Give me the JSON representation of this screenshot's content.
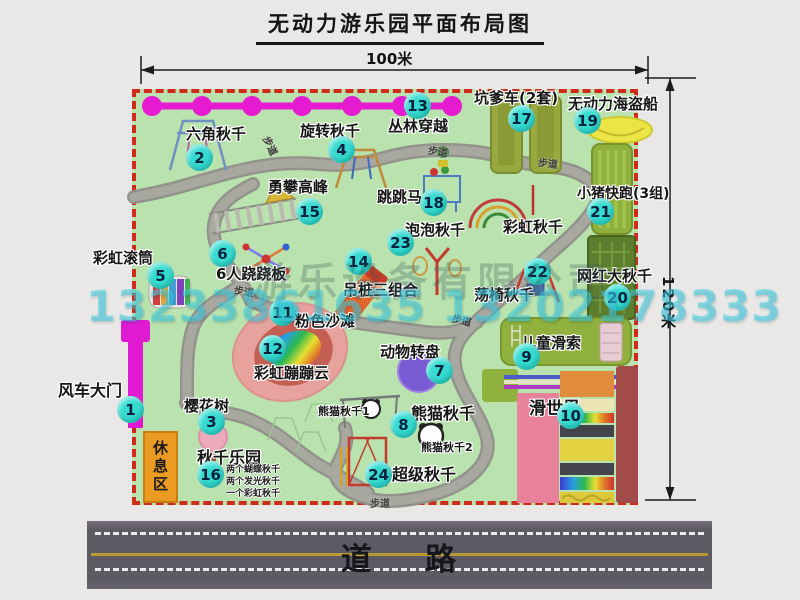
{
  "title": "无动力游乐园平面布局图",
  "dimensions": {
    "width": "100米",
    "height": "120米"
  },
  "road_label": "道    路",
  "walkway_label": "步道",
  "rest_area_label": "休息区",
  "watermark": {
    "company": "游乐设备有限公司",
    "phone": "13233861635 13202178333"
  },
  "attractions": [
    {
      "num": "1",
      "label": "风车大门"
    },
    {
      "num": "2",
      "label": "六角秋千"
    },
    {
      "num": "3",
      "label": "樱花树"
    },
    {
      "num": "4",
      "label": "旋转秋千"
    },
    {
      "num": "5",
      "label": "彩虹滚筒"
    },
    {
      "num": "6",
      "label": "6人跷跷板"
    },
    {
      "num": "7",
      "label": "动物转盘"
    },
    {
      "num": "8",
      "label": "熊猫秋千"
    },
    {
      "num": "9",
      "label": "儿童滑索"
    },
    {
      "num": "10",
      "label": "滑世界"
    },
    {
      "num": "11",
      "label": "粉色沙滩"
    },
    {
      "num": "12",
      "label": "彩虹蹦蹦云"
    },
    {
      "num": "13",
      "label": "丛林穿越"
    },
    {
      "num": "14",
      "label": "吊桩三组合"
    },
    {
      "num": "15",
      "label": "勇攀高峰"
    },
    {
      "num": "16",
      "label": "秋千乐园"
    },
    {
      "num": "17",
      "label": "坑爹车(2套)"
    },
    {
      "num": "18",
      "label": "跳跳马"
    },
    {
      "num": "19",
      "label": "无动力海盗船"
    },
    {
      "num": "20",
      "label": "网红大秋千"
    },
    {
      "num": "21",
      "label": "小猪快跑(3组)"
    },
    {
      "num": "22",
      "label": "荡椅秋千"
    },
    {
      "num": "23",
      "label": "泡泡秋千"
    },
    {
      "num": "24",
      "label": "超级秋千"
    }
  ],
  "annotations": {
    "rainbow_swing": "彩虹秋千",
    "panda_swing_1": "熊猫秋千1",
    "panda_swing_2": "熊猫秋千2",
    "swing_notes": [
      "两个蝴蝶秋千",
      "两个发光秋千",
      "一个彩虹秋千"
    ]
  },
  "colors": {
    "park_green": "#b9e2ae",
    "border_red": "#d02a1a",
    "badge_cyan": "#35dbd1",
    "gate_magenta": "#e01ad2",
    "road_gray": "#5e5a64",
    "rest_orange": "#ec9b22"
  }
}
